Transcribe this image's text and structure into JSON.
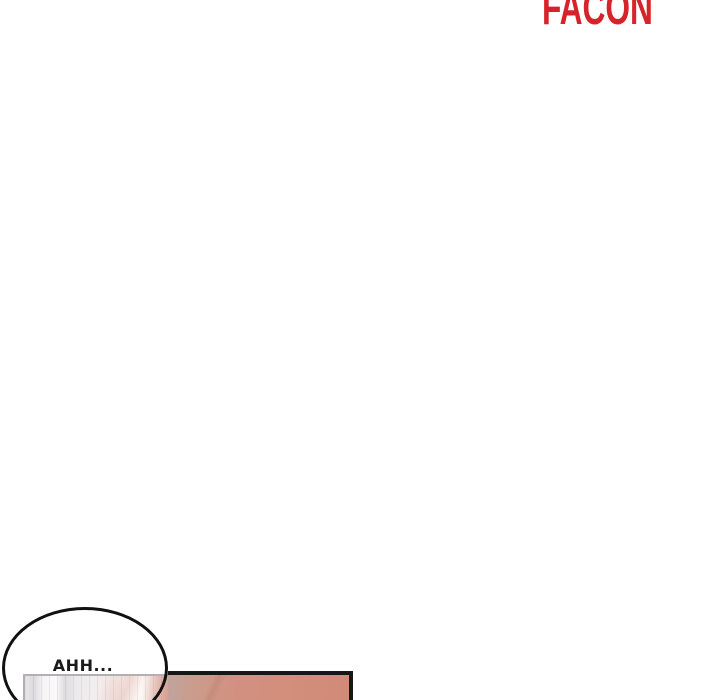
{
  "watermark": {
    "text": "FACON",
    "color": "#d7242a"
  },
  "speech_bubble": {
    "text": "AHH...",
    "fill_color": "#ffffff",
    "stroke_color": "#111111",
    "text_color": "#1a1a1a"
  },
  "panels": {
    "left_panel": {
      "content": "blurred doorway interior",
      "border_color": "#b2b0b3",
      "tones": [
        "#f6f3f4",
        "#dfdce0",
        "#eedfda",
        "#dfc0b6"
      ]
    },
    "right_panel": {
      "content": "salmon gradient scene",
      "border_color": "#161616",
      "fill_from": "#bfa49e",
      "fill_to": "#d18a78"
    }
  }
}
